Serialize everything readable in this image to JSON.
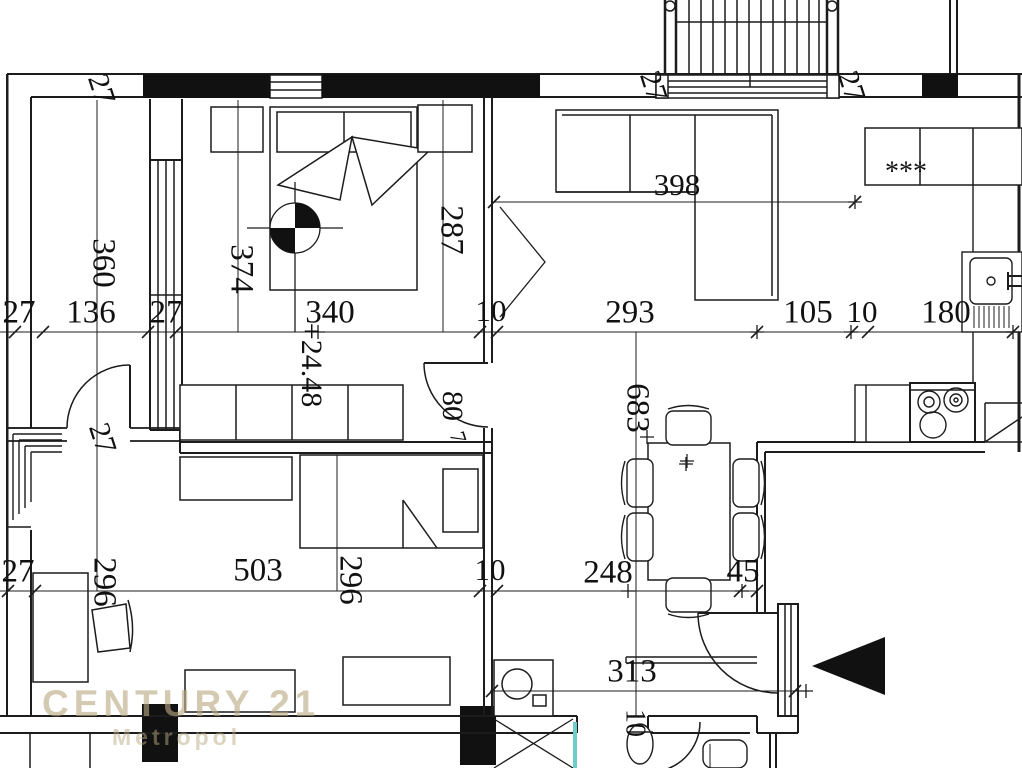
{
  "watermark": {
    "brand": "CENTURY 21",
    "sub": "Metropol"
  },
  "plan": {
    "hob_symbol": "***",
    "elevation_label": "+24.48",
    "entry_arrow": "entry-direction-left",
    "colors": {
      "line": "#1c1c1c",
      "watermark": "#baa982",
      "shower_glass": "#6fcdc9",
      "hob_text": "#909090"
    },
    "labels": [
      {
        "t": "27",
        "x": 99,
        "y": 90,
        "r": 72,
        "s": 30
      },
      {
        "t": "27",
        "x": 651,
        "y": 87,
        "r": 72,
        "s": 30
      },
      {
        "t": "27",
        "x": 849,
        "y": 87,
        "r": 72,
        "s": 30
      },
      {
        "t": "360",
        "x": 101,
        "y": 263,
        "r": 90,
        "s": 33
      },
      {
        "t": "374",
        "x": 239,
        "y": 269,
        "r": 90,
        "s": 33
      },
      {
        "t": "287",
        "x": 449,
        "y": 230,
        "r": 90,
        "s": 33
      },
      {
        "t": "398",
        "x": 677,
        "y": 188,
        "r": 0,
        "s": 31
      },
      {
        "t": "+24.48",
        "x": 309,
        "y": 365,
        "r": 90,
        "s": 30
      },
      {
        "t": "27",
        "x": 19,
        "y": 315,
        "r": 0,
        "s": 33
      },
      {
        "t": "136",
        "x": 91,
        "y": 315,
        "r": 0,
        "s": 33
      },
      {
        "t": "27",
        "x": 166,
        "y": 315,
        "r": 0,
        "s": 33
      },
      {
        "t": "340",
        "x": 330,
        "y": 315,
        "r": 0,
        "s": 33
      },
      {
        "t": "10",
        "x": 491,
        "y": 314,
        "r": 0,
        "s": 31
      },
      {
        "t": "293",
        "x": 630,
        "y": 315,
        "r": 0,
        "s": 33
      },
      {
        "t": "105",
        "x": 808,
        "y": 315,
        "r": 0,
        "s": 33
      },
      {
        "t": "10",
        "x": 862,
        "y": 315,
        "r": 0,
        "s": 31
      },
      {
        "t": "180",
        "x": 946,
        "y": 315,
        "r": 0,
        "s": 33
      },
      {
        "t": "80",
        "x": 450,
        "y": 406,
        "r": 90,
        "s": 30
      },
      {
        "t": "7",
        "x": 456,
        "y": 438,
        "r": 72,
        "s": 22
      },
      {
        "t": "683",
        "x": 635,
        "y": 408,
        "r": 90,
        "s": 33
      },
      {
        "t": "27",
        "x": 100,
        "y": 439,
        "r": 72,
        "s": 30
      },
      {
        "t": "27",
        "x": 18,
        "y": 574,
        "r": 0,
        "s": 33
      },
      {
        "t": "296",
        "x": 102,
        "y": 582,
        "r": 90,
        "s": 33
      },
      {
        "t": "503",
        "x": 258,
        "y": 573,
        "r": 0,
        "s": 33
      },
      {
        "t": "296",
        "x": 348,
        "y": 580,
        "r": 90,
        "s": 33
      },
      {
        "t": "10",
        "x": 490,
        "y": 573,
        "r": 0,
        "s": 31
      },
      {
        "t": "248",
        "x": 608,
        "y": 575,
        "r": 0,
        "s": 33
      },
      {
        "t": "45",
        "x": 743,
        "y": 574,
        "r": 0,
        "s": 33
      },
      {
        "t": "313",
        "x": 632,
        "y": 674,
        "r": 0,
        "s": 33
      },
      {
        "t": "10",
        "x": 633,
        "y": 723,
        "r": 90,
        "s": 28
      },
      {
        "t": "***",
        "x": 906,
        "y": 174,
        "r": 0,
        "s": 28,
        "c": "#909090"
      }
    ]
  }
}
